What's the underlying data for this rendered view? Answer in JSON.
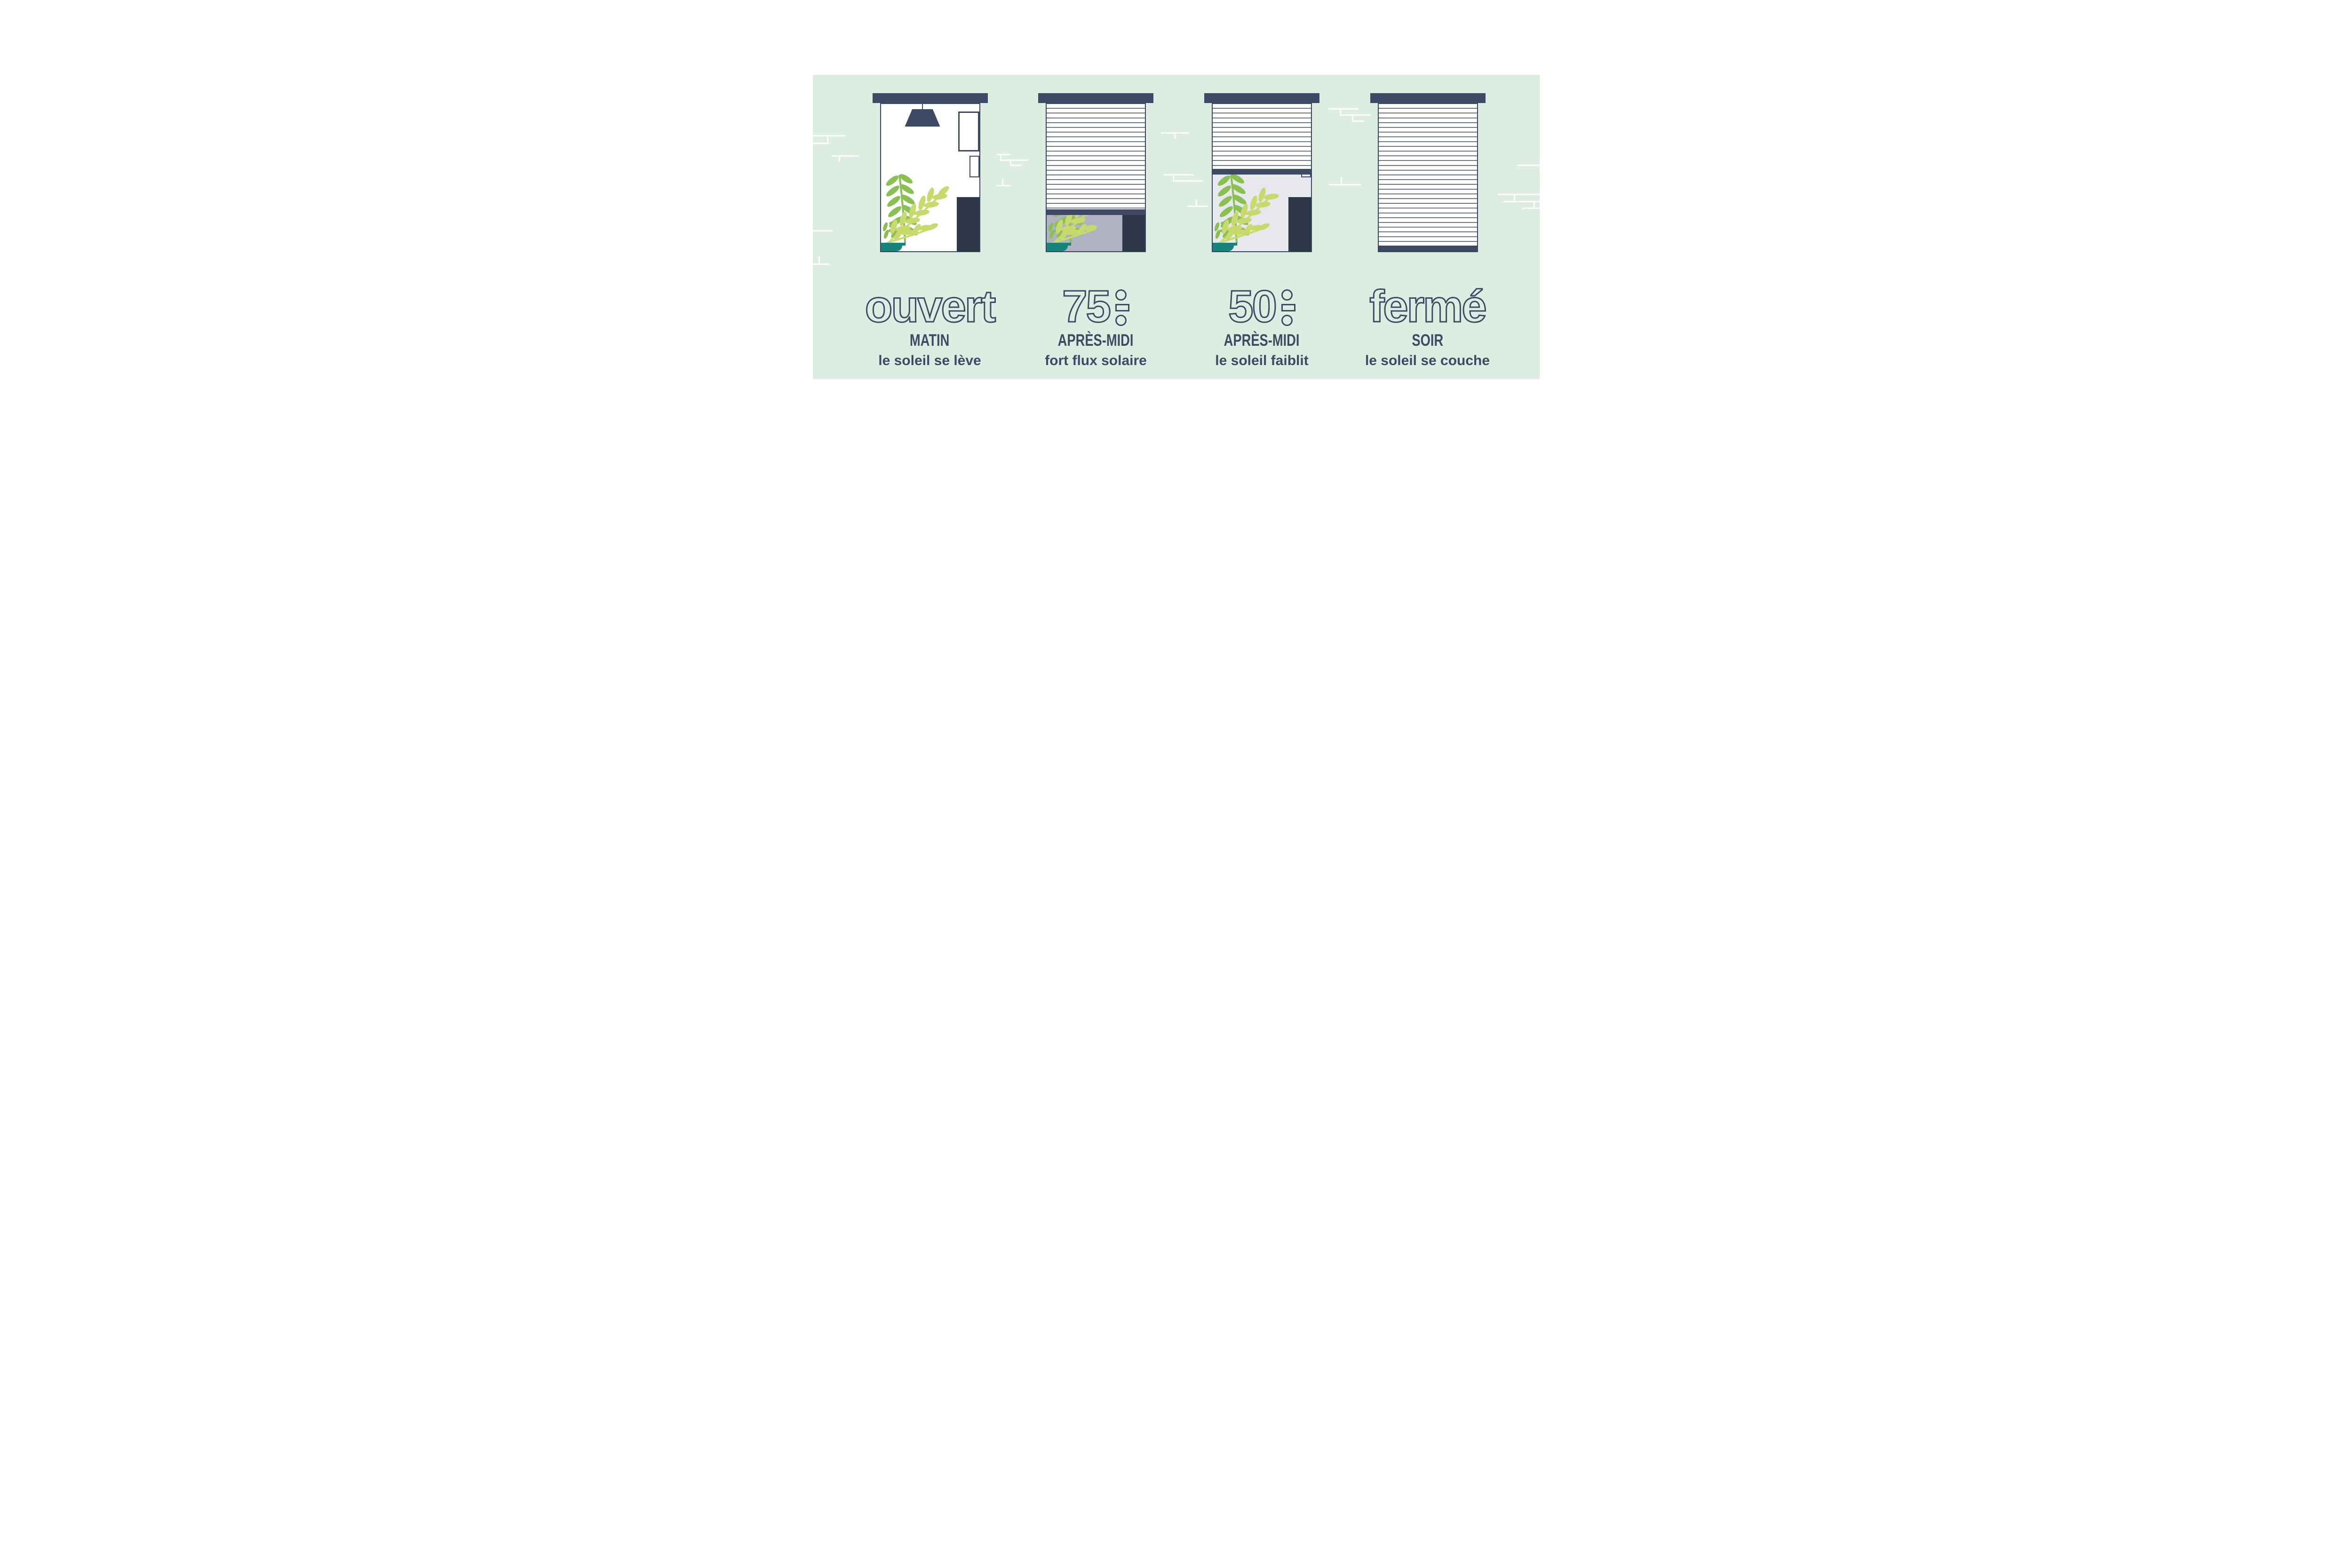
{
  "infographic": {
    "subject": "roller-shutter positions through the day",
    "colors": {
      "band_green": "#deede2",
      "navy": "#3e4a63",
      "furniture_navy": "#2d3748",
      "room_dim_gray": "#aeb2c2",
      "room_light_gray": "#e7e8ee",
      "plant_green": "#8abf52",
      "plant_light_green": "#c8d96e",
      "pot_teal": "#17837d",
      "background_white": "#ffffff"
    },
    "columns": [
      {
        "id": "open",
        "big_label": "ouvert",
        "percent_digits": null,
        "time_label": "MATIN",
        "description": "le soleil se lève",
        "shutter_closed_percent": 0
      },
      {
        "id": "p75",
        "big_label": "75",
        "percent_digits": "75",
        "time_label": "APRÈS-MIDI",
        "description": "fort flux solaire",
        "shutter_closed_percent": 75
      },
      {
        "id": "p50",
        "big_label": "50",
        "percent_digits": "50",
        "time_label": "APRÈS-MIDI",
        "description": "le soleil faiblit",
        "shutter_closed_percent": 50
      },
      {
        "id": "closed",
        "big_label": "fermé",
        "percent_digits": null,
        "time_label": "SOIR",
        "description": "le soleil se couche",
        "shutter_closed_percent": 100
      }
    ]
  }
}
